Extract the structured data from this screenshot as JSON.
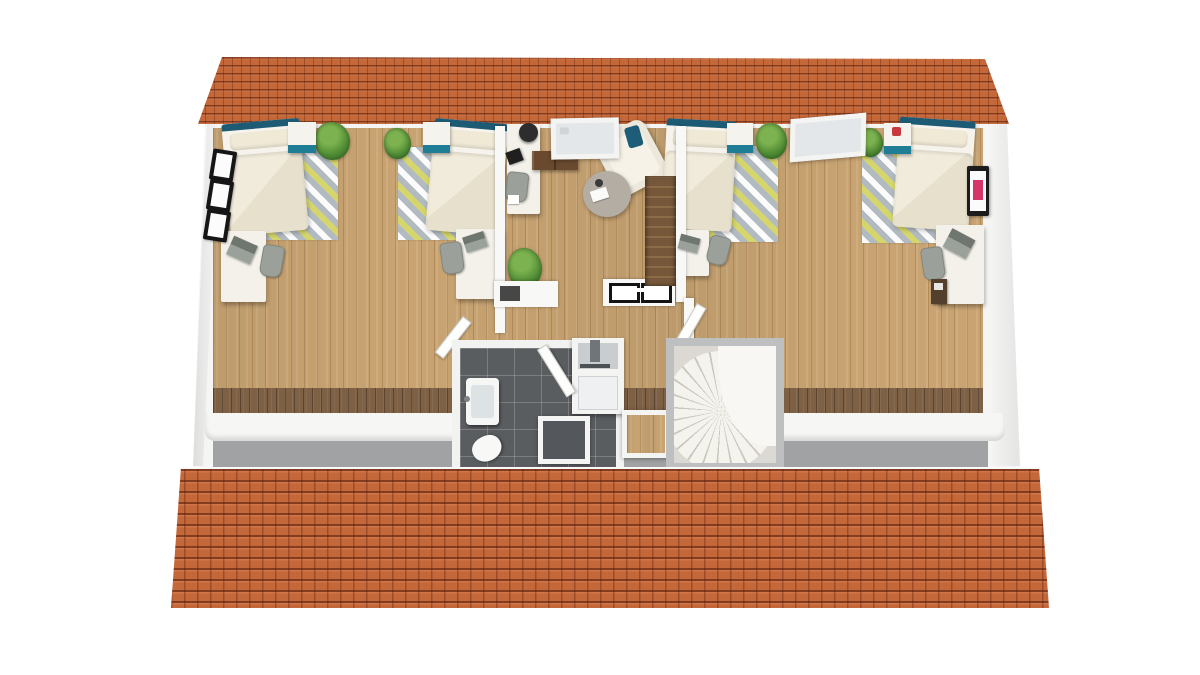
{
  "scene": {
    "description": "3D rendered architectural floor plan of an attic storey viewed from above; orange tiled roof slopes at top and bottom, white walls, light wood flooring; no visible text in the image",
    "background": "#ffffff"
  },
  "palette": {
    "roof_tile": "#c4683a",
    "roof_tile_joint": "#8a3a1c",
    "wood_floor": "#c9a472",
    "dark_wood_border": "#7e6044",
    "wall_white": "#f5f5f4",
    "eaves_gray": "#a0a2a3",
    "bathroom_tile": "#5a5d60",
    "accent_teal_headboard": "#1d5b74",
    "accent_teal_drawer": "#1f7d95",
    "rug_yellow": "#d6d55f",
    "rug_gray": "#b0b9c0",
    "duvet_cream": "#ebe4d2",
    "stair_wood": "#7b5a3b",
    "wall_art_pink": "#d6356a",
    "plant_green": "#4e8a33"
  },
  "structure": {
    "roof_back_slope": "narrow tiled strip across the top",
    "roof_front_slope": "wide tiled slope across the bottom",
    "knee_wall": "white low wall with gray eaves floor strip along the bottom of the plan"
  },
  "rooms": {
    "bedroom_left": {
      "furniture": [
        "bed-1",
        "nightstand-1",
        "rug-1",
        "desk-1",
        "chair-1",
        "plant-1",
        "plant-2",
        "bed-2",
        "nightstand-2",
        "rug-2",
        "desk-2",
        "chair-2",
        "gable-window-x3"
      ]
    },
    "office_landing": {
      "furniture": [
        "office-desk",
        "office-chair-black",
        "task-chair",
        "laptop",
        "sideboard",
        "roof-window",
        "armchair-with-teal-pillow",
        "round-coffee-table",
        "straight-staircase",
        "plant-3",
        "electrical-panel-symbols"
      ]
    },
    "bedroom_right": {
      "furniture": [
        "bed-3",
        "nightstand-3",
        "rug-3",
        "desk-3",
        "chair-3",
        "plant-4",
        "tilted-roof-window",
        "plant-5",
        "bed-4",
        "nightstand-4",
        "rug-4",
        "desk-4",
        "chair-4",
        "drawer-unit",
        "wall-art-pink"
      ]
    },
    "bathroom": {
      "furniture": [
        "vanity-sink",
        "toilet",
        "shower-enclosure",
        "floor-roof-window"
      ]
    },
    "stair_lobby": {
      "furniture": [
        "spiral-staircase",
        "floor-roof-window-2",
        "open-doors"
      ]
    }
  }
}
